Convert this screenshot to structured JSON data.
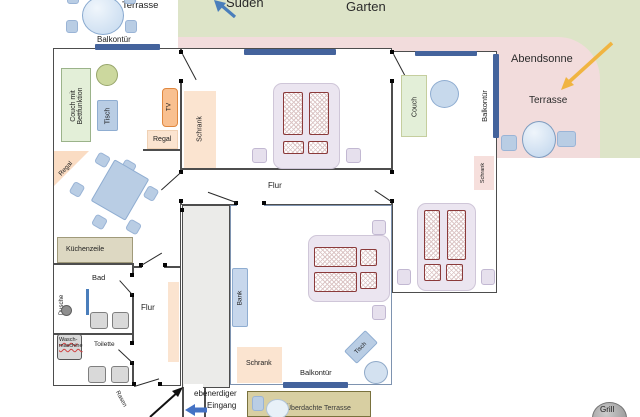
{
  "canvas": {
    "width": 640,
    "height": 417
  },
  "colors": {
    "garden_green": "#dde4c8",
    "terrace_pink": "#f2dcdc",
    "wall_gray": "#4d4d4d",
    "balcony_door_blue": "#44639c",
    "mattress_red": "#8b3a3a",
    "south_arrow_blue": "#4a7ebb",
    "entrance_arrow_blue": "#4472c4",
    "sunset_arrow_orange": "#f0b441"
  },
  "outdoor": {
    "garten": "Garten",
    "sueden": "Süden",
    "terrasse_top_left": "Terrasse",
    "balkontuer_top_left": "Balkontür",
    "abendsonne": "Abendsonne",
    "terrasse_right": "Terrasse",
    "ueberdachte_terrasse": "Überdachte Terrasse",
    "eingang_line1": "ebenerdiger",
    "eingang_line2": "Eingang",
    "grill": "Grill",
    "rasen": "Rasen"
  },
  "living_room": {
    "couch_line1": "Couch mit",
    "couch_line2": "Bettfunktion",
    "tisch": "Tisch",
    "tv": "TV",
    "regal_wall": "Regal",
    "regal_corner": "Regal"
  },
  "kitchen_bath": {
    "kuechenzeile": "Küchenzeile",
    "bad": "Bad",
    "dusche": "Dusche",
    "waschmaschine_line1": "Wasch-",
    "waschmaschine_line2": "maschine",
    "toilette": "Toilette",
    "flur": "Flur"
  },
  "bedroom_top": {
    "schrank": "Schrank"
  },
  "hallway": {
    "flur": "Flur"
  },
  "bedroom_bottom": {
    "bank": "Bank",
    "schrank": "Schrank",
    "tisch": "Tisch",
    "balkontuer": "Balkontür"
  },
  "room_right": {
    "couch": "Couch",
    "balkontuer": "Balkontür",
    "schrank": "Schrank"
  }
}
